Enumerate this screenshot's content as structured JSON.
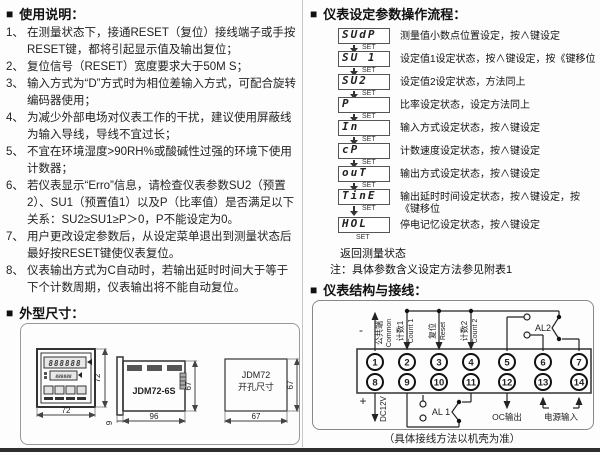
{
  "bullet": "■",
  "colors": {
    "paper": "#ffffff",
    "ink": "#222222"
  },
  "usage": {
    "title": "使用说明：",
    "items": [
      {
        "num": "1、",
        "text": "在测量状态下，接通RESET（复位）接线端子或手按RESET键，都将引起显示值及输出复位；"
      },
      {
        "num": "2、",
        "text": "复位信号（RESET）宽度要求大于50M S；"
      },
      {
        "num": "3、",
        "text": "输入方式为“D”方式时为相位差输入方式，可配合旋转编码器使用；"
      },
      {
        "num": "4、",
        "text": "为减少外部电场对仪表工作的干扰，建议使用屏蔽线为输入导线，导线不宜过长；"
      },
      {
        "num": "5、",
        "text": "不宜在环境湿度>90RH%或酸碱性过强的环境下使用计数器；"
      },
      {
        "num": "6、",
        "text": "若仪表显示“Erro”信息，请检查仪表参数SU2（预置2）、SU1（预置值1）以及P（比率值）是否满足以下关系：SU2≥SU1≥P＞0，P不能设定为0。"
      },
      {
        "num": "7、",
        "text": "用户更改设定参数后，从设定菜单退出到测量状态后最好按RESET键使仪表复位。"
      },
      {
        "num": "8、",
        "text": "仪表输出方式为C自动时，若输出延时时间大于等于下个计数周期，仪表输出将不能自动复位。"
      }
    ]
  },
  "dimensions": {
    "title": "外型尺寸：",
    "front": {
      "digits": "888888",
      "digits2": "888888",
      "w": "72",
      "h": "72"
    },
    "side": {
      "model": "JDM72-6S",
      "w": "96",
      "h": "67",
      "d": "9"
    },
    "cutout": {
      "l1": "JDM72",
      "l2": "开孔尺寸",
      "w": "67",
      "h": "67"
    }
  },
  "flow": {
    "title": "仪表设定参数操作流程：",
    "set_label": "SET",
    "steps": [
      {
        "display": "SUdP",
        "desc": "测量值小数点位置设定，按∧键设定"
      },
      {
        "display": "SU 1",
        "desc": "设定值1设定状态，按∧键设定，按《键移位"
      },
      {
        "display": "SU2",
        "desc": "设定值2设定状态，方法同上"
      },
      {
        "display": "P",
        "desc": "比率设定状态，设定方法同上"
      },
      {
        "display": "In",
        "desc": "输入方式设定状态，按∧键设定"
      },
      {
        "display": "cP",
        "desc": "计数速度设定状态，按∧键设定"
      },
      {
        "display": "ouT",
        "desc": "输出方式设定状态，按∧键设定"
      },
      {
        "display": "TinE",
        "desc": "输出延时时间设定状态，按∧键设定，按《键移位"
      },
      {
        "display": "HOL",
        "desc": "停电记忆设定状态，按∧键设定"
      }
    ],
    "return_label": "返回测量状态",
    "note": "注：具体参数含义设定方法参见附表1"
  },
  "wiring": {
    "title": "仪表结构与接线：",
    "terminals": [
      "1",
      "2",
      "3",
      "4",
      "5",
      "6",
      "7",
      "8",
      "9",
      "10",
      "11",
      "12",
      "13",
      "14"
    ],
    "labels": {
      "minus": "-",
      "plus": "+",
      "common_cn": "公共端",
      "common_en": "Common",
      "count1_cn": "计数1",
      "count1_en": "Count 1",
      "reset_cn": "复位",
      "reset_en": "Reset",
      "count2_cn": "计数2",
      "count2_en": "Count 2",
      "al2": "AL2",
      "al1": "AL 1",
      "dc12v": "DC12V",
      "oc": "OC输出",
      "power": "电源输入"
    },
    "caption": "（具体接线方法以机壳为准）"
  }
}
